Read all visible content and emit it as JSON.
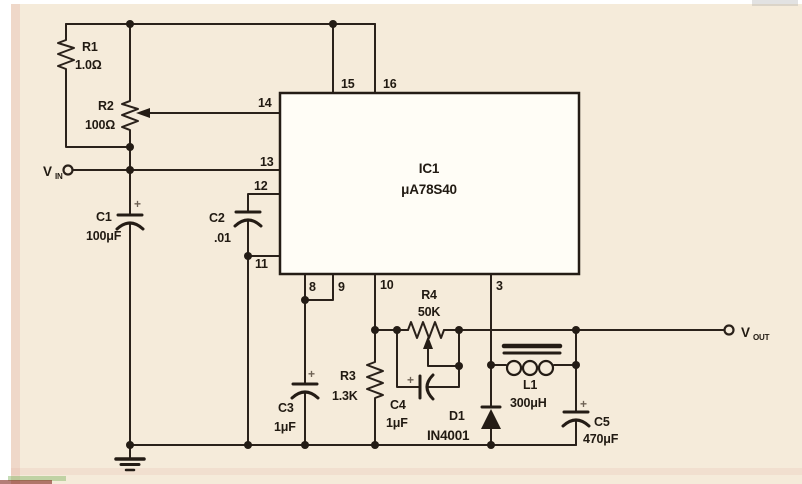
{
  "diagram_type": "circuit-schematic",
  "ic": {
    "ref": "IC1",
    "part": "μA78S40",
    "pins": {
      "p3": "3",
      "p8": "8",
      "p9": "9",
      "p10": "10",
      "p11": "11",
      "p12": "12",
      "p13": "13",
      "p14": "14",
      "p15": "15",
      "p16": "16"
    }
  },
  "components": {
    "r1": {
      "ref": "R1",
      "value": "1.0Ω"
    },
    "r2": {
      "ref": "R2",
      "value": "100Ω"
    },
    "r3": {
      "ref": "R3",
      "value": "1.3K"
    },
    "r4": {
      "ref": "R4",
      "value": "50K"
    },
    "c1": {
      "ref": "C1",
      "value": "100μF"
    },
    "c2": {
      "ref": "C2",
      "value": ".01"
    },
    "c3": {
      "ref": "C3",
      "value": "1μF"
    },
    "c4": {
      "ref": "C4",
      "value": "1μF"
    },
    "c5": {
      "ref": "C5",
      "value": "470μF"
    },
    "d1": {
      "ref": "D1",
      "value": "IN4001"
    },
    "l1": {
      "ref": "L1",
      "value": "300μH"
    }
  },
  "terminals": {
    "vin": {
      "letter": "V",
      "sub": "IN"
    },
    "vout": {
      "letter": "V",
      "sub": "OUT"
    }
  },
  "symbols": {
    "plus": "+"
  },
  "colors": {
    "background": "#f5ebda",
    "ink": "#2a211a",
    "ic_fill": "#fffdf6"
  }
}
